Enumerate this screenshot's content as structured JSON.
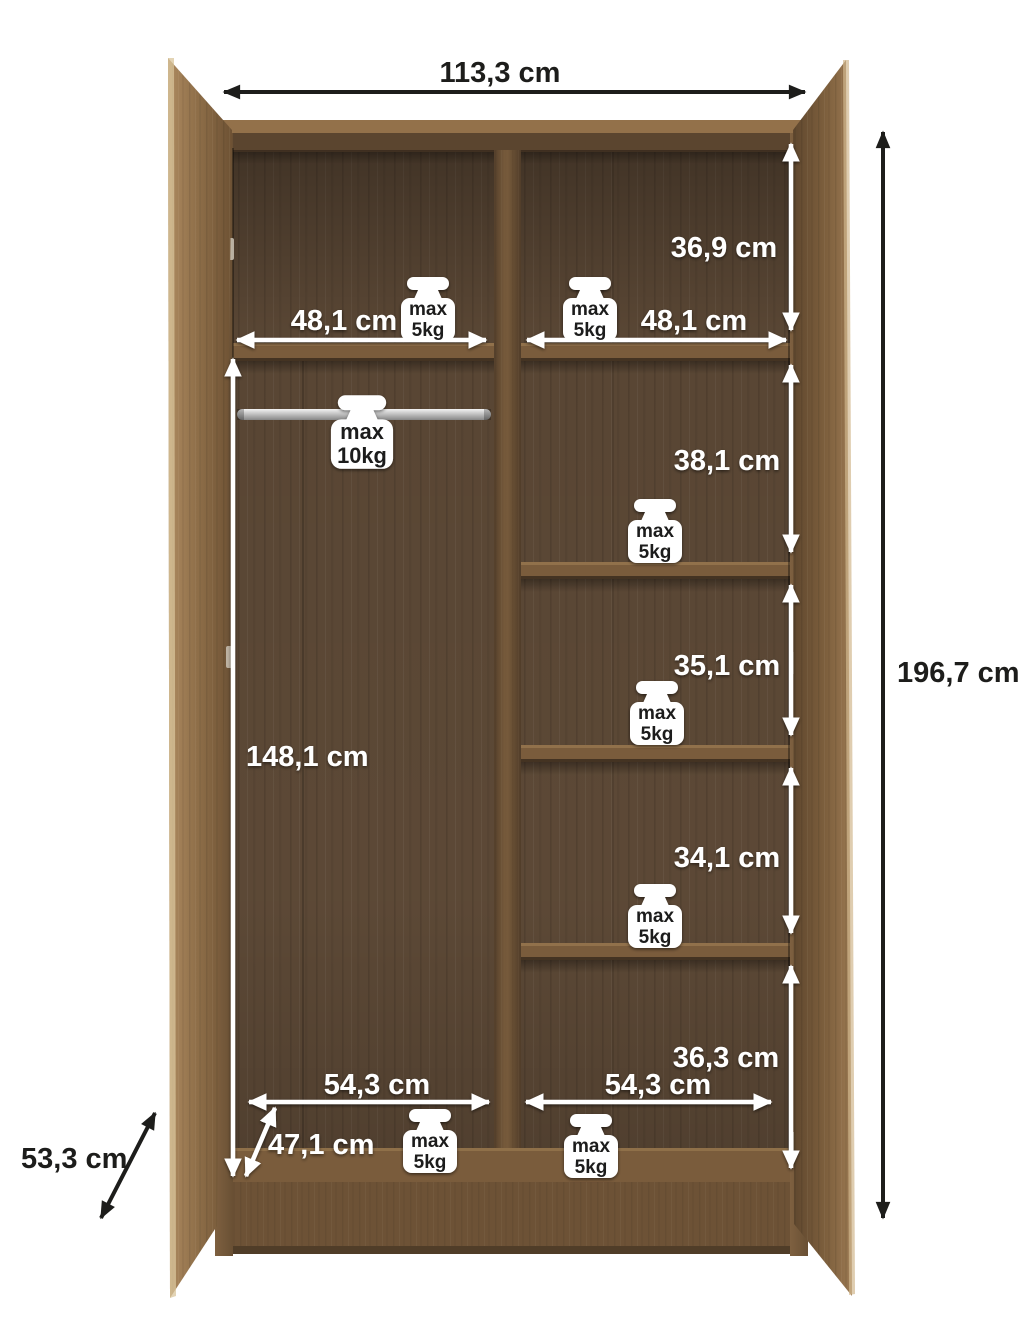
{
  "title": "Wardrobe interior dimensions diagram",
  "units": "cm",
  "colors": {
    "background": "#ffffff",
    "door_wood_light": "#a3825a",
    "door_wood_dark": "#6b5134",
    "frame_wood": "#77593a",
    "interior_wood": "#5e4a37",
    "shelf_wood": "#7a5c3c",
    "rod_silver": "#c9c9c9",
    "annotation_white": "#ffffff",
    "annotation_black": "#1d1d1b"
  },
  "overall": {
    "width_label": "113,3 cm",
    "height_label": "196,7 cm",
    "depth_label": "53,3 cm"
  },
  "left_section": {
    "shelf_width_label": "48,1 cm",
    "hanging_space_height_label": "148,1 cm",
    "bottom_width_label": "54,3 cm",
    "bottom_depth_label": "47,1 cm",
    "rod_max_load": {
      "line1": "max",
      "line2": "10kg"
    }
  },
  "right_section": {
    "shelf_width_label": "48,1 cm",
    "bottom_width_label": "54,3 cm",
    "section_heights": [
      "36,9 cm",
      "38,1 cm",
      "35,1 cm",
      "34,1 cm",
      "36,3 cm"
    ]
  },
  "shelf_max_load": {
    "line1": "max",
    "line2": "5kg"
  }
}
